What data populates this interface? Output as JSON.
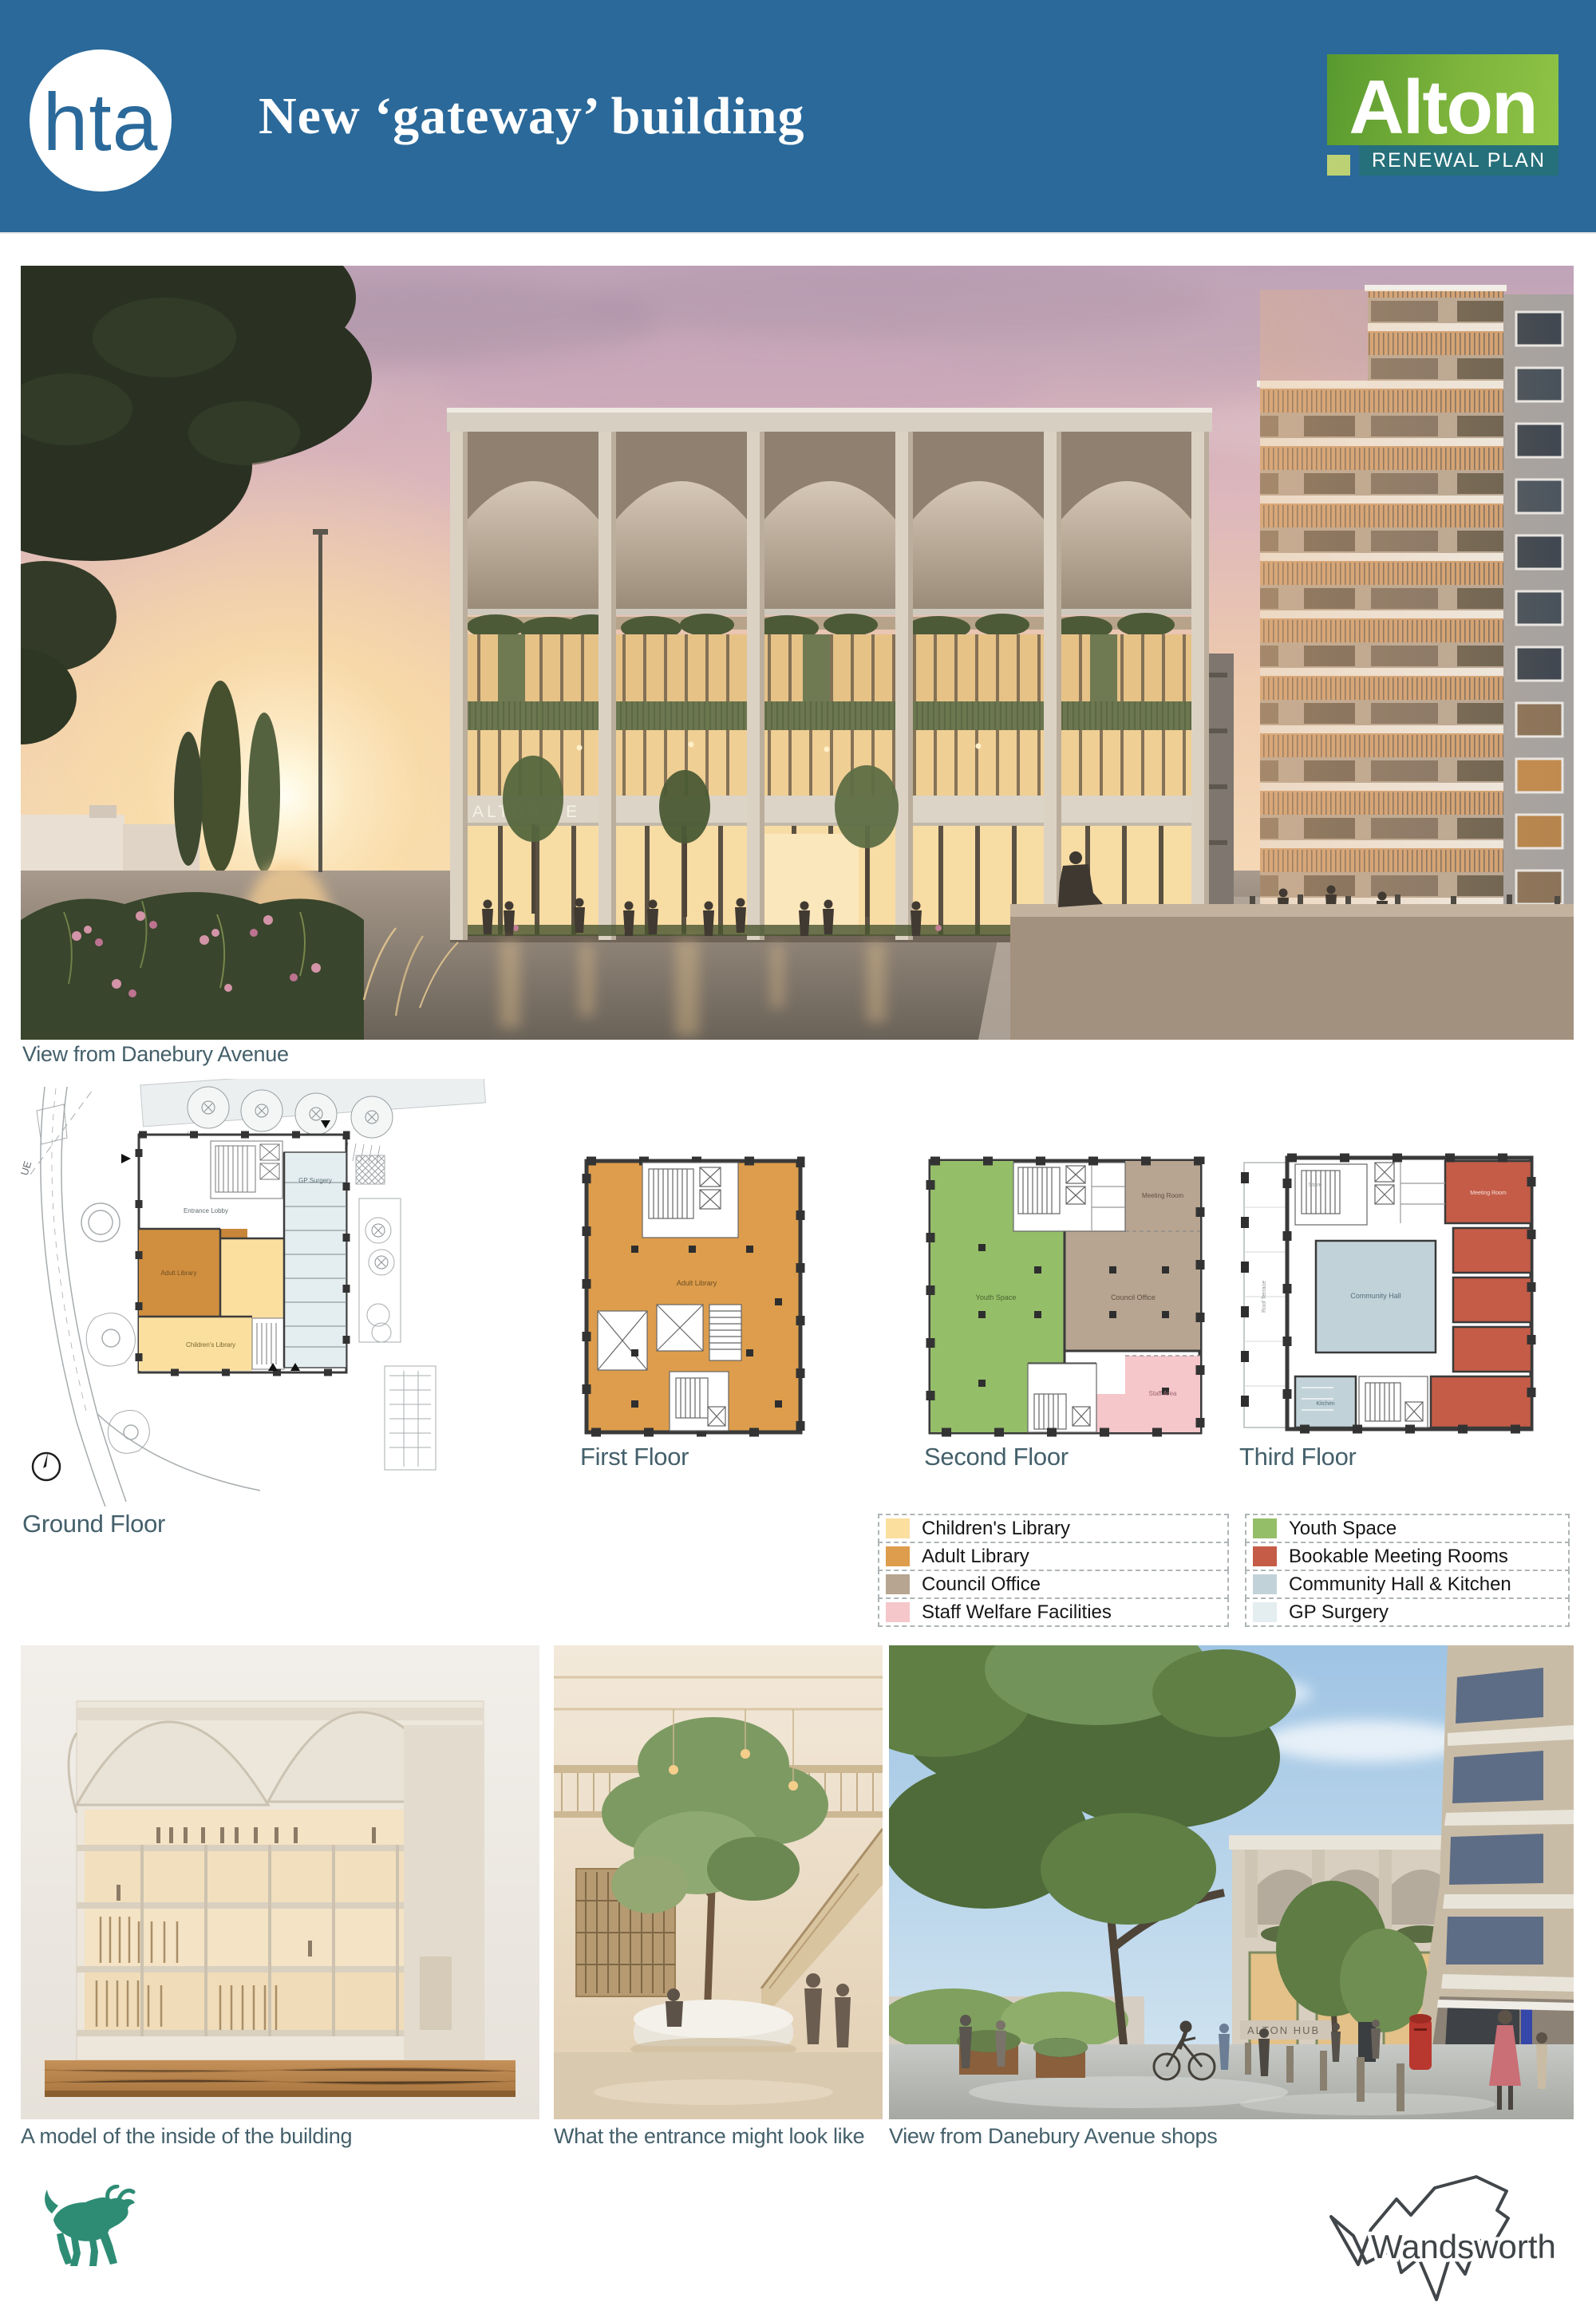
{
  "header": {
    "hta": "hta",
    "title": "New ‘gateway’ building",
    "alton_name": "Alton",
    "alton_tagline": "RENEWAL PLAN"
  },
  "captions": {
    "main_view": "View from Danebury Avenue",
    "ground": "Ground Floor",
    "first": "First Floor",
    "second": "Second Floor",
    "third": "Third Floor",
    "model": "A model of the inside of the building",
    "entrance": "What the entrance might look like",
    "shops_view": "View from Danebury Avenue shops"
  },
  "signs": {
    "main_building": "ALTON HE",
    "shops_building": "ALTON HUB"
  },
  "plan_labels": {
    "ground": {
      "entrance": "Entrance Lobby",
      "adult": "Adult Library",
      "children": "Children's Library",
      "gp": "GP Surgery",
      "road_fragment": "UE"
    },
    "first": {
      "adult": "Adult Library"
    },
    "second": {
      "youth": "Youth Space",
      "council": "Council Office",
      "meeting": "Meeting Room",
      "staff": "Staff Area"
    },
    "third": {
      "hall": "Community Hall",
      "kitchen": "Kitchen",
      "meeting": "Meeting Room",
      "terrace": "Roof Terrace",
      "store": "Store"
    }
  },
  "legend": {
    "left": [
      {
        "label": "Children's Library",
        "color": "#FADF9F"
      },
      {
        "label": "Adult Library",
        "color": "#DD9D4C"
      },
      {
        "label": "Council Office",
        "color": "#B7A591"
      },
      {
        "label": "Staff Welfare Facilities",
        "color": "#F5C6CA"
      }
    ],
    "right": [
      {
        "label": "Youth Space",
        "color": "#95BE69"
      },
      {
        "label": "Bookable Meeting Rooms",
        "color": "#C55C47"
      },
      {
        "label": "Community Hall & Kitchen",
        "color": "#C2D2D9"
      },
      {
        "label": "GP Surgery",
        "color": "#E4EDEF"
      }
    ]
  },
  "footer": {
    "wandsworth": "Wandsworth"
  }
}
